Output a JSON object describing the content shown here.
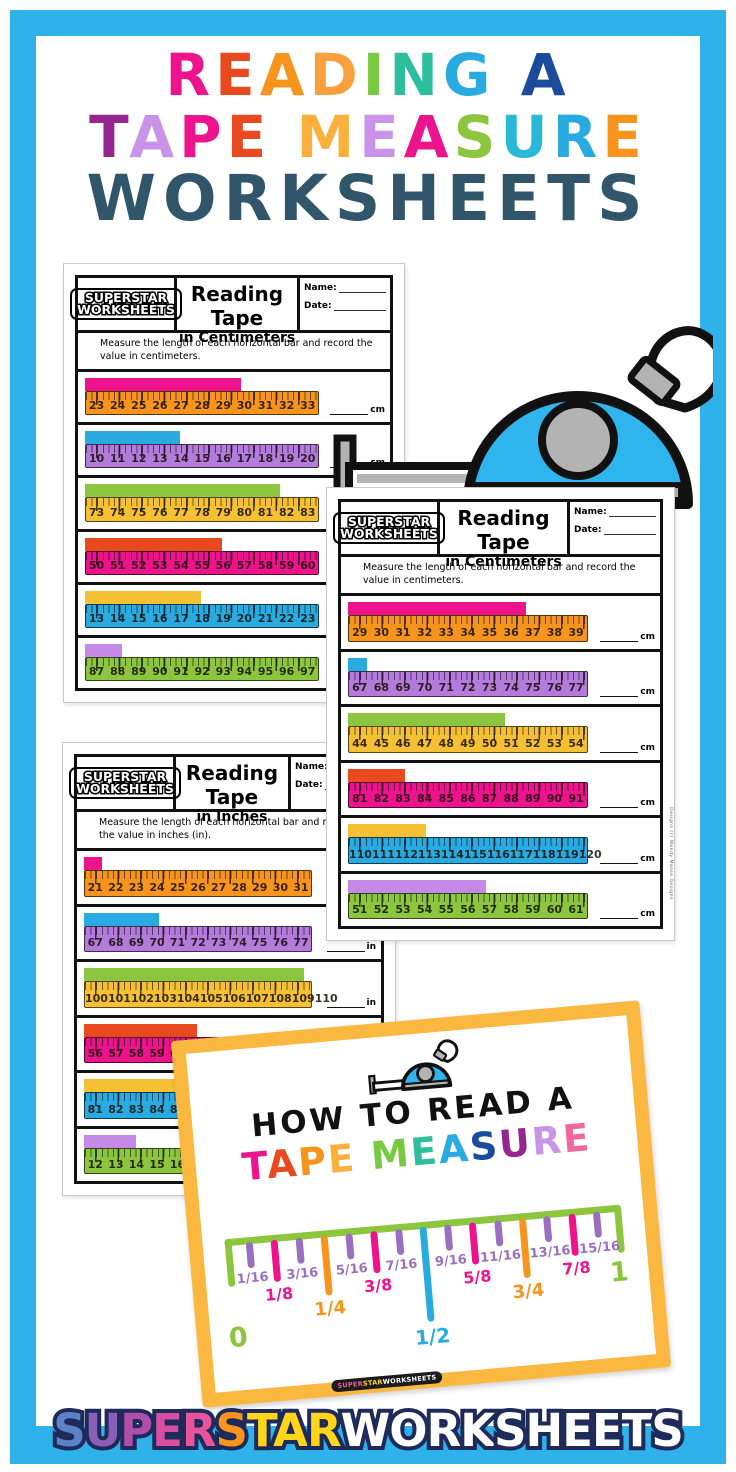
{
  "colors": {
    "frame": "#2FB1EA",
    "pink": "#EC138C",
    "redorange": "#E8491F",
    "orange": "#F7941E",
    "gold": "#F5C033",
    "green": "#8CC63F",
    "teal": "#2DBE9E",
    "blue": "#29ABE2",
    "navy": "#1B4C9C",
    "purple": "#93278F",
    "lavender": "#C893E8",
    "slate": "#31566B",
    "ruler_purple": "#B57BDC",
    "poster_border": "#FBB840"
  },
  "title": {
    "line1": [
      {
        "ch": "R",
        "c": "#EC138C"
      },
      {
        "ch": "E",
        "c": "#E8491F"
      },
      {
        "ch": "A",
        "c": "#F7941E"
      },
      {
        "ch": "D",
        "c": "#F9A03C"
      },
      {
        "ch": "I",
        "c": "#7AC943"
      },
      {
        "ch": "N",
        "c": "#2DBE9E"
      },
      {
        "ch": "G",
        "c": "#29ABE2"
      },
      {
        "ch": " ",
        "c": "#000"
      },
      {
        "ch": "A",
        "c": "#1B4C9C"
      }
    ],
    "line2": [
      {
        "ch": "T",
        "c": "#93278F"
      },
      {
        "ch": "A",
        "c": "#C893E8"
      },
      {
        "ch": "P",
        "c": "#EC138C"
      },
      {
        "ch": "E",
        "c": "#E8491F"
      },
      {
        "ch": " ",
        "c": "#000"
      },
      {
        "ch": "M",
        "c": "#FBB03B"
      },
      {
        "ch": "E",
        "c": "#C893E8"
      },
      {
        "ch": "A",
        "c": "#EC138C"
      },
      {
        "ch": "S",
        "c": "#8CC63F"
      },
      {
        "ch": "U",
        "c": "#29B8D8"
      },
      {
        "ch": "R",
        "c": "#29ABE2"
      },
      {
        "ch": "E",
        "c": "#F7941E"
      }
    ],
    "line3": {
      "text": "WORKSHEETS",
      "color": "#31566B"
    }
  },
  "worksheets": [
    {
      "brand_line1": "SUPERSTAR",
      "brand_line2": "WORKSHEETS",
      "title_line1": "Reading Tape",
      "title_line2": "in Centimeters",
      "name_label": "Name:",
      "date_label": "Date:",
      "instructions": "Measure the length of each horizontal bar and record the value in centimeters.",
      "unit": "cm",
      "side_credit": "",
      "rows": [
        {
          "bar_color": "#EC138C",
          "ruler_color": "#F7941E",
          "numbers": [
            23,
            24,
            25,
            26,
            27,
            28,
            29,
            30,
            31,
            32,
            33
          ],
          "bar_frac": 0.67
        },
        {
          "bar_color": "#29ABE2",
          "ruler_color": "#B57BDC",
          "numbers": [
            10,
            11,
            12,
            13,
            14,
            15,
            16,
            17,
            18,
            19,
            20
          ],
          "bar_frac": 0.41
        },
        {
          "bar_color": "#8CC63F",
          "ruler_color": "#F5C033",
          "numbers": [
            73,
            74,
            75,
            76,
            77,
            78,
            79,
            80,
            81,
            82,
            83
          ],
          "bar_frac": 0.84
        },
        {
          "bar_color": "#E8491F",
          "ruler_color": "#EC138C",
          "numbers": [
            50,
            51,
            52,
            53,
            54,
            55,
            56,
            57,
            58,
            59,
            60
          ],
          "bar_frac": 0.59
        },
        {
          "bar_color": "#F5C033",
          "ruler_color": "#29ABE2",
          "numbers": [
            13,
            14,
            15,
            16,
            17,
            18,
            19,
            20,
            21,
            22,
            23
          ],
          "bar_frac": 0.5
        },
        {
          "bar_color": "#C689E8",
          "ruler_color": "#8CC63F",
          "numbers": [
            87,
            88,
            89,
            90,
            91,
            92,
            93,
            94,
            95,
            96,
            97
          ],
          "bar_frac": 0.16
        }
      ]
    },
    {
      "brand_line1": "SUPERSTAR",
      "brand_line2": "WORKSHEETS",
      "title_line1": "Reading Tape",
      "title_line2": "in Centimeters",
      "name_label": "Name:",
      "date_label": "Date:",
      "instructions": "Measure the length of each horizontal bar and record the value in centimeters.",
      "unit": "cm",
      "side_credit": "Designs (c) Wendy Moose Designs",
      "rows": [
        {
          "bar_color": "#EC138C",
          "ruler_color": "#F7941E",
          "numbers": [
            29,
            30,
            31,
            32,
            33,
            34,
            35,
            36,
            37,
            38,
            39
          ],
          "bar_frac": 0.75
        },
        {
          "bar_color": "#29ABE2",
          "ruler_color": "#B57BDC",
          "numbers": [
            67,
            68,
            69,
            70,
            71,
            72,
            73,
            74,
            75,
            76,
            77
          ],
          "bar_frac": 0.08
        },
        {
          "bar_color": "#8CC63F",
          "ruler_color": "#F5C033",
          "numbers": [
            44,
            45,
            46,
            47,
            48,
            49,
            50,
            51,
            52,
            53,
            54
          ],
          "bar_frac": 0.66
        },
        {
          "bar_color": "#E8491F",
          "ruler_color": "#EC138C",
          "numbers": [
            81,
            82,
            83,
            84,
            85,
            86,
            87,
            88,
            89,
            90,
            91
          ],
          "bar_frac": 0.24
        },
        {
          "bar_color": "#F5C033",
          "ruler_color": "#29ABE2",
          "numbers": [
            110,
            111,
            112,
            113,
            114,
            115,
            116,
            117,
            118,
            119,
            120
          ],
          "bar_frac": 0.33
        },
        {
          "bar_color": "#C689E8",
          "ruler_color": "#8CC63F",
          "numbers": [
            51,
            52,
            53,
            54,
            55,
            56,
            57,
            58,
            59,
            60,
            61
          ],
          "bar_frac": 0.58
        }
      ]
    },
    {
      "brand_line1": "SUPERSTAR",
      "brand_line2": "WORKSHEETS",
      "title_line1": "Reading Tape",
      "title_line2": "in Inches",
      "name_label": "Name:",
      "date_label": "Date:",
      "instructions": "Measure the length of each horizontal bar and record the value in inches (in).",
      "unit": "in",
      "side_credit": "",
      "rows": [
        {
          "bar_color": "#EC138C",
          "ruler_color": "#F7941E",
          "numbers": [
            21,
            22,
            23,
            24,
            25,
            26,
            27,
            28,
            29,
            30,
            31
          ],
          "bar_frac": 0.08
        },
        {
          "bar_color": "#29ABE2",
          "ruler_color": "#B57BDC",
          "numbers": [
            67,
            68,
            69,
            70,
            71,
            72,
            73,
            74,
            75,
            76,
            77
          ],
          "bar_frac": 0.33
        },
        {
          "bar_color": "#8CC63F",
          "ruler_color": "#F5C033",
          "numbers": [
            100,
            101,
            102,
            103,
            104,
            105,
            106,
            107,
            108,
            109,
            110
          ],
          "bar_frac": 0.97
        },
        {
          "bar_color": "#E8491F",
          "ruler_color": "#EC138C",
          "numbers": [
            56,
            57,
            58,
            59,
            60,
            61,
            62,
            63,
            64,
            65,
            66
          ],
          "bar_frac": 0.5
        },
        {
          "bar_color": "#F5C033",
          "ruler_color": "#29ABE2",
          "numbers": [
            81,
            82,
            83,
            84,
            85,
            86,
            87,
            88,
            89,
            90,
            91
          ],
          "bar_frac": 0.45
        },
        {
          "bar_color": "#C689E8",
          "ruler_color": "#8CC63F",
          "numbers": [
            12,
            13,
            14,
            15,
            16,
            17,
            18,
            19,
            20,
            21,
            22
          ],
          "bar_frac": 0.23
        }
      ]
    }
  ],
  "poster": {
    "heading": "HOW TO READ A",
    "word": [
      {
        "ch": "T",
        "c": "#EC138C"
      },
      {
        "ch": "A",
        "c": "#E8491F"
      },
      {
        "ch": "P",
        "c": "#F7941E"
      },
      {
        "ch": "E",
        "c": "#FBB03B"
      },
      {
        "ch": " ",
        "c": "#000"
      },
      {
        "ch": "M",
        "c": "#7AC943"
      },
      {
        "ch": "E",
        "c": "#2DBE9E"
      },
      {
        "ch": "A",
        "c": "#29ABE2"
      },
      {
        "ch": "S",
        "c": "#1B4C9C"
      },
      {
        "ch": "U",
        "c": "#93278F"
      },
      {
        "ch": "R",
        "c": "#C893E8"
      },
      {
        "ch": "E",
        "c": "#F0699E"
      }
    ],
    "ruler": {
      "start_label": "0",
      "end_label": "1",
      "line_color": "#8CC63F",
      "ticks": [
        {
          "label": "1/16",
          "color": "#9B6FC0",
          "size": "s"
        },
        {
          "label": "1/8",
          "color": "#EC138C",
          "size": "m"
        },
        {
          "label": "3/16",
          "color": "#9B6FC0",
          "size": "s"
        },
        {
          "label": "1/4",
          "color": "#F7941E",
          "size": "l"
        },
        {
          "label": "5/16",
          "color": "#9B6FC0",
          "size": "s"
        },
        {
          "label": "3/8",
          "color": "#EC138C",
          "size": "m"
        },
        {
          "label": "7/16",
          "color": "#9B6FC0",
          "size": "s"
        },
        {
          "label": "1/2",
          "color": "#29ABE2",
          "size": "xl"
        },
        {
          "label": "9/16",
          "color": "#9B6FC0",
          "size": "s"
        },
        {
          "label": "5/8",
          "color": "#EC138C",
          "size": "m"
        },
        {
          "label": "11/16",
          "color": "#9B6FC0",
          "size": "s"
        },
        {
          "label": "3/4",
          "color": "#F7941E",
          "size": "l"
        },
        {
          "label": "13/16",
          "color": "#9B6FC0",
          "size": "s"
        },
        {
          "label": "7/8",
          "color": "#EC138C",
          "size": "m"
        },
        {
          "label": "15/16",
          "color": "#9B6FC0",
          "size": "s"
        }
      ]
    },
    "badge": [
      {
        "text": "SUPER",
        "c": "#E85BA0"
      },
      {
        "text": "STAR",
        "c": "#FFD519"
      },
      {
        "text": "WORKSHEETS",
        "c": "#FFFFFF"
      }
    ]
  },
  "footer_logo": [
    {
      "ch": "S",
      "c": "#5A82C4"
    },
    {
      "ch": "U",
      "c": "#8A5FB8"
    },
    {
      "ch": "P",
      "c": "#AF4FAB"
    },
    {
      "ch": "E",
      "c": "#D84FA2"
    },
    {
      "ch": "R",
      "c": "#E8549B"
    },
    {
      "ch": "S",
      "c": "#F7941E"
    },
    {
      "ch": "T",
      "c": "#FFD519"
    },
    {
      "ch": "A",
      "c": "#FFD519"
    },
    {
      "ch": "R",
      "c": "#FFD519"
    },
    {
      "ch": "W",
      "c": "#FFFFFF"
    },
    {
      "ch": "O",
      "c": "#FFFFFF"
    },
    {
      "ch": "R",
      "c": "#FFFFFF"
    },
    {
      "ch": "K",
      "c": "#FFFFFF"
    },
    {
      "ch": "S",
      "c": "#FFFFFF"
    },
    {
      "ch": "H",
      "c": "#FFFFFF"
    },
    {
      "ch": "E",
      "c": "#FFFFFF"
    },
    {
      "ch": "E",
      "c": "#FFFFFF"
    },
    {
      "ch": "T",
      "c": "#FFFFFF"
    },
    {
      "ch": "S",
      "c": "#FFFFFF"
    }
  ]
}
